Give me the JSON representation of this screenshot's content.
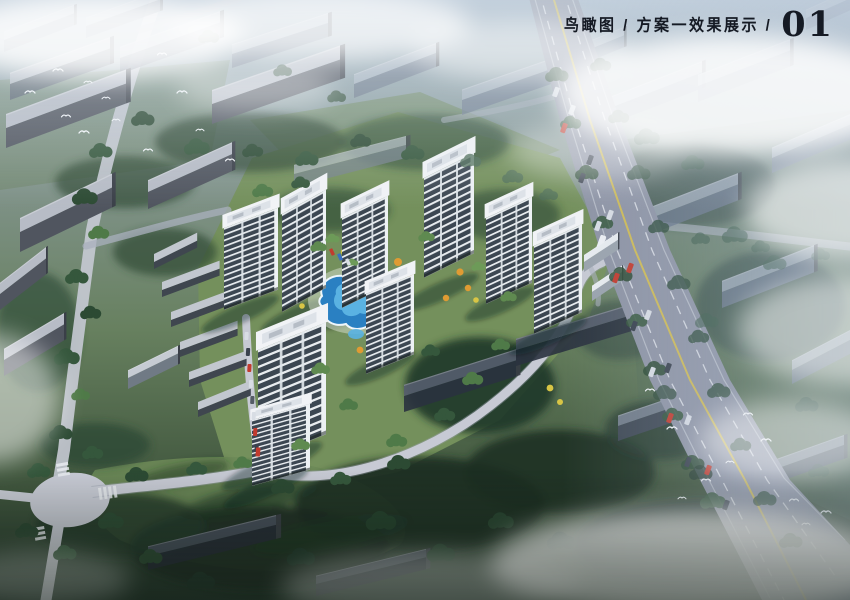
{
  "header": {
    "title": "鸟瞰图 / 方案一效果展示 /",
    "page_number": "01"
  },
  "scene": {
    "description": "Aerial bird's-eye architectural rendering: cluster of white residential high-rise towers with central blue pool amenity and orange/yellow landscaping, surrounded by existing grey housing blocks, tree-lined local roads, a diagonal arterial highway with traffic, flying birds and drifting fog.",
    "colors": {
      "title": "#151a24",
      "sky_haze": "#a9bacb",
      "ground": "#5e7854",
      "ground_dark": "#1f2f26",
      "lawn": "#7e9a63",
      "tree_dark": "#1e3226",
      "tree_mid": "#35573c",
      "tree_light": "#4f7a48",
      "road": "#aab0bd",
      "road_light": "#c7cad4",
      "highway": "#8e94a5",
      "lane_yellow": "#d6bf4e",
      "context_roof": "#b7bcc6",
      "context_face": "#50555f",
      "context_hazy": "#8391a3",
      "tower_roof": "#f1f3f6",
      "tower_glass": "#3c4752",
      "tower_band": "#e8ecef",
      "pool": "#2a80c2",
      "pool_light": "#5ab2e2",
      "accent_orange": "#df9b33",
      "accent_yellow": "#d8c545",
      "cloud": "#ffffff",
      "car_red": "#c23b2e",
      "bird": "#f4f7fa"
    }
  }
}
